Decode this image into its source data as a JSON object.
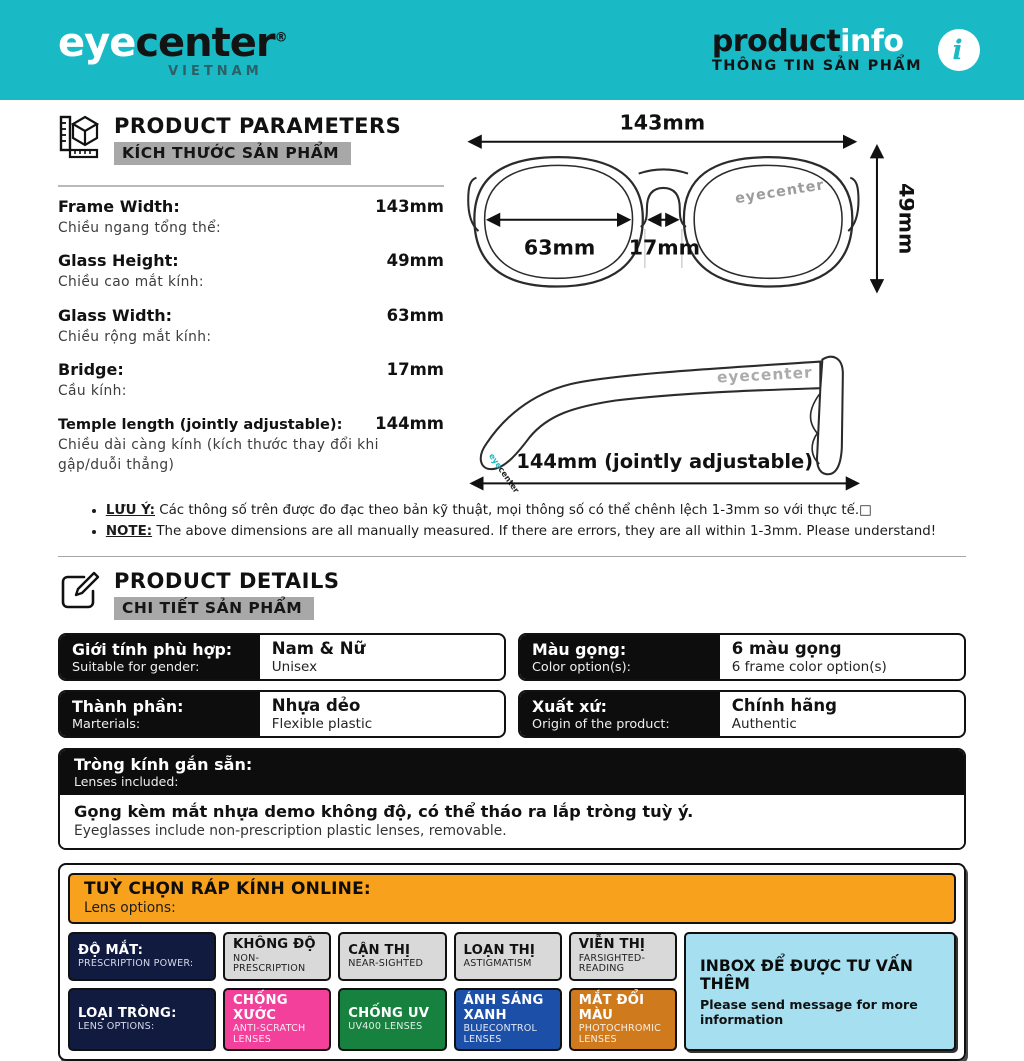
{
  "colors": {
    "teal": "#19bac6",
    "orange_bar": "#f7a11c",
    "navy": "#111b40",
    "gray_chip": "#d9d9d9",
    "pink": "#f2409b",
    "green": "#17813f",
    "blue": "#1b4fa8",
    "amber": "#cf7a1c",
    "cyan_light": "#a6dff0"
  },
  "header": {
    "logo_eye": "eye",
    "logo_center": "center",
    "logo_reg": "®",
    "logo_sub": "VIETNAM",
    "title_product": "product",
    "title_info": "info",
    "title_sub": "THÔNG TIN SẢN PHẨM",
    "info_glyph": "i"
  },
  "parameters": {
    "heading": "PRODUCT PARAMETERS",
    "heading_vi": "KÍCH THƯỚC SẢN PHẨM",
    "rows": [
      {
        "label": "Frame Width:",
        "sub": "Chiều ngang tổng thể:",
        "value": "143mm"
      },
      {
        "label": "Glass Height:",
        "sub": "Chiều cao mắt kính:",
        "value": "49mm"
      },
      {
        "label": "Glass Width:",
        "sub": "Chiều rộng mắt kính:",
        "value": "63mm"
      },
      {
        "label": "Bridge:",
        "sub": "Cầu kính:",
        "value": "17mm"
      },
      {
        "label": "Temple length (jointly adjustable):",
        "sub": "Chiều dài càng kính (kích thước thay đổi khi gập/duỗi thẳng)",
        "value": "144mm"
      }
    ],
    "diagram_front": {
      "width_label": "143mm",
      "height_label": "49mm",
      "lens_label": "63mm",
      "bridge_label": "17mm",
      "watermark": "eyecenter"
    },
    "diagram_side": {
      "temple_label": "144mm (jointly adjustable)",
      "watermark": "eyecenter",
      "tip_eye": "eye",
      "tip_center": "center"
    },
    "notes": [
      {
        "head": "LƯU Ý:",
        "text": " Các thông số trên được đo đạc theo bản kỹ thuật, mọi thông số có thể chênh lệch 1-3mm so với thực tế.□"
      },
      {
        "head": "NOTE:",
        "text": " The above dimensions are all manually measured. If there are errors, they are all within 1-3mm. Please understand!"
      }
    ]
  },
  "details": {
    "heading": "PRODUCT DETAILS",
    "heading_vi": "CHI TIẾT SẢN PHẨM",
    "cells": [
      {
        "label": "Giới tính phù hợp:",
        "label_sub": "Suitable for gender:",
        "value": "Nam & Nữ",
        "value_sub": "Unisex"
      },
      {
        "label": "Màu gọng:",
        "label_sub": "Color option(s):",
        "value": "6 màu gọng",
        "value_sub": "6 frame color option(s)"
      },
      {
        "label": "Thành phần:",
        "label_sub": "Marterials:",
        "value": "Nhựa dẻo",
        "value_sub": "Flexible plastic"
      },
      {
        "label": "Xuất xứ:",
        "label_sub": "Origin of the product:",
        "value": "Chính hãng",
        "value_sub": "Authentic"
      }
    ],
    "lenses_included": {
      "label": "Tròng kính gắn sẵn:",
      "label_sub": "Lenses included:",
      "value": "Gọng kèm mắt nhựa demo không độ, có thể tháo ra lắp tròng tuỳ ý.",
      "value_sub": "Eyeglasses include non-prescription plastic lenses, removable."
    }
  },
  "lens_options": {
    "heading": "TUỲ CHỌN RÁP KÍNH ONLINE:",
    "heading_sub": "Lens options:",
    "row1_label": {
      "title": "ĐỘ MẮT:",
      "sub": "PRESCRIPTION POWER:"
    },
    "row1": [
      {
        "title": "KHÔNG ĐỘ",
        "sub": "NON-PRESCRIPTION"
      },
      {
        "title": "CẬN THỊ",
        "sub": "NEAR-SIGHTED"
      },
      {
        "title": "LOẠN THỊ",
        "sub": "ASTIGMATISM"
      },
      {
        "title": "VIỄN THỊ",
        "sub": "FARSIGHTED-READING"
      }
    ],
    "row2_label": {
      "title": "LOẠI TRÒNG:",
      "sub": "LENS OPTIONS:"
    },
    "row2": [
      {
        "title": "CHỐNG XƯỚC",
        "sub": "ANTI-SCRATCH LENSES",
        "color": "#f2409b"
      },
      {
        "title": "CHỐNG UV",
        "sub": "UV400 LENSES",
        "color": "#17813f"
      },
      {
        "title": "ÁNH SÁNG XANH",
        "sub": "BLUECONTROL LENSES",
        "color": "#1b4fa8"
      },
      {
        "title": "MẮT ĐỔI MÀU",
        "sub": "PHOTOCHROMIC LENSES",
        "color": "#cf7a1c"
      }
    ],
    "inbox": {
      "title": "INBOX ĐỂ ĐƯỢC TƯ VẤN THÊM",
      "sub": "Please send message for more information"
    }
  }
}
